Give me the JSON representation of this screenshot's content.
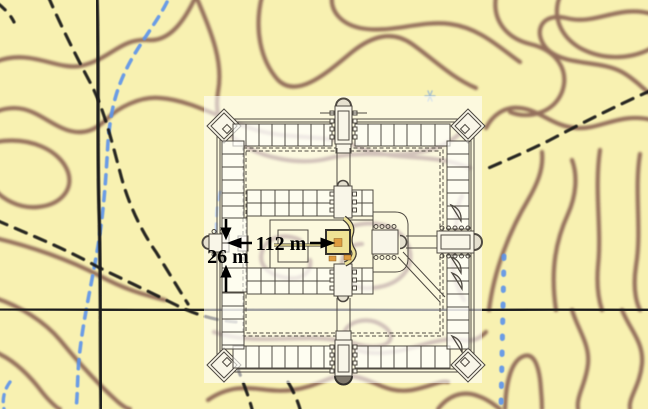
{
  "annotations": {
    "width_label": "112 m",
    "height_label": "26 m"
  },
  "colors": {
    "map_background": "#F8F1B1",
    "contour_brown": "#7E5348",
    "stream_blue": "#5B93EB",
    "road_black": "#1A1A1A",
    "trail_black": "#141414",
    "overlay_white": "#FFFFFF",
    "plan_line": "#4F4A42",
    "sanctuary_yellow": "#EFE295",
    "sanctuary_orange": "#DE9C40",
    "apse_dark": "#7E776B",
    "apse_light": "#E6E1D0"
  }
}
